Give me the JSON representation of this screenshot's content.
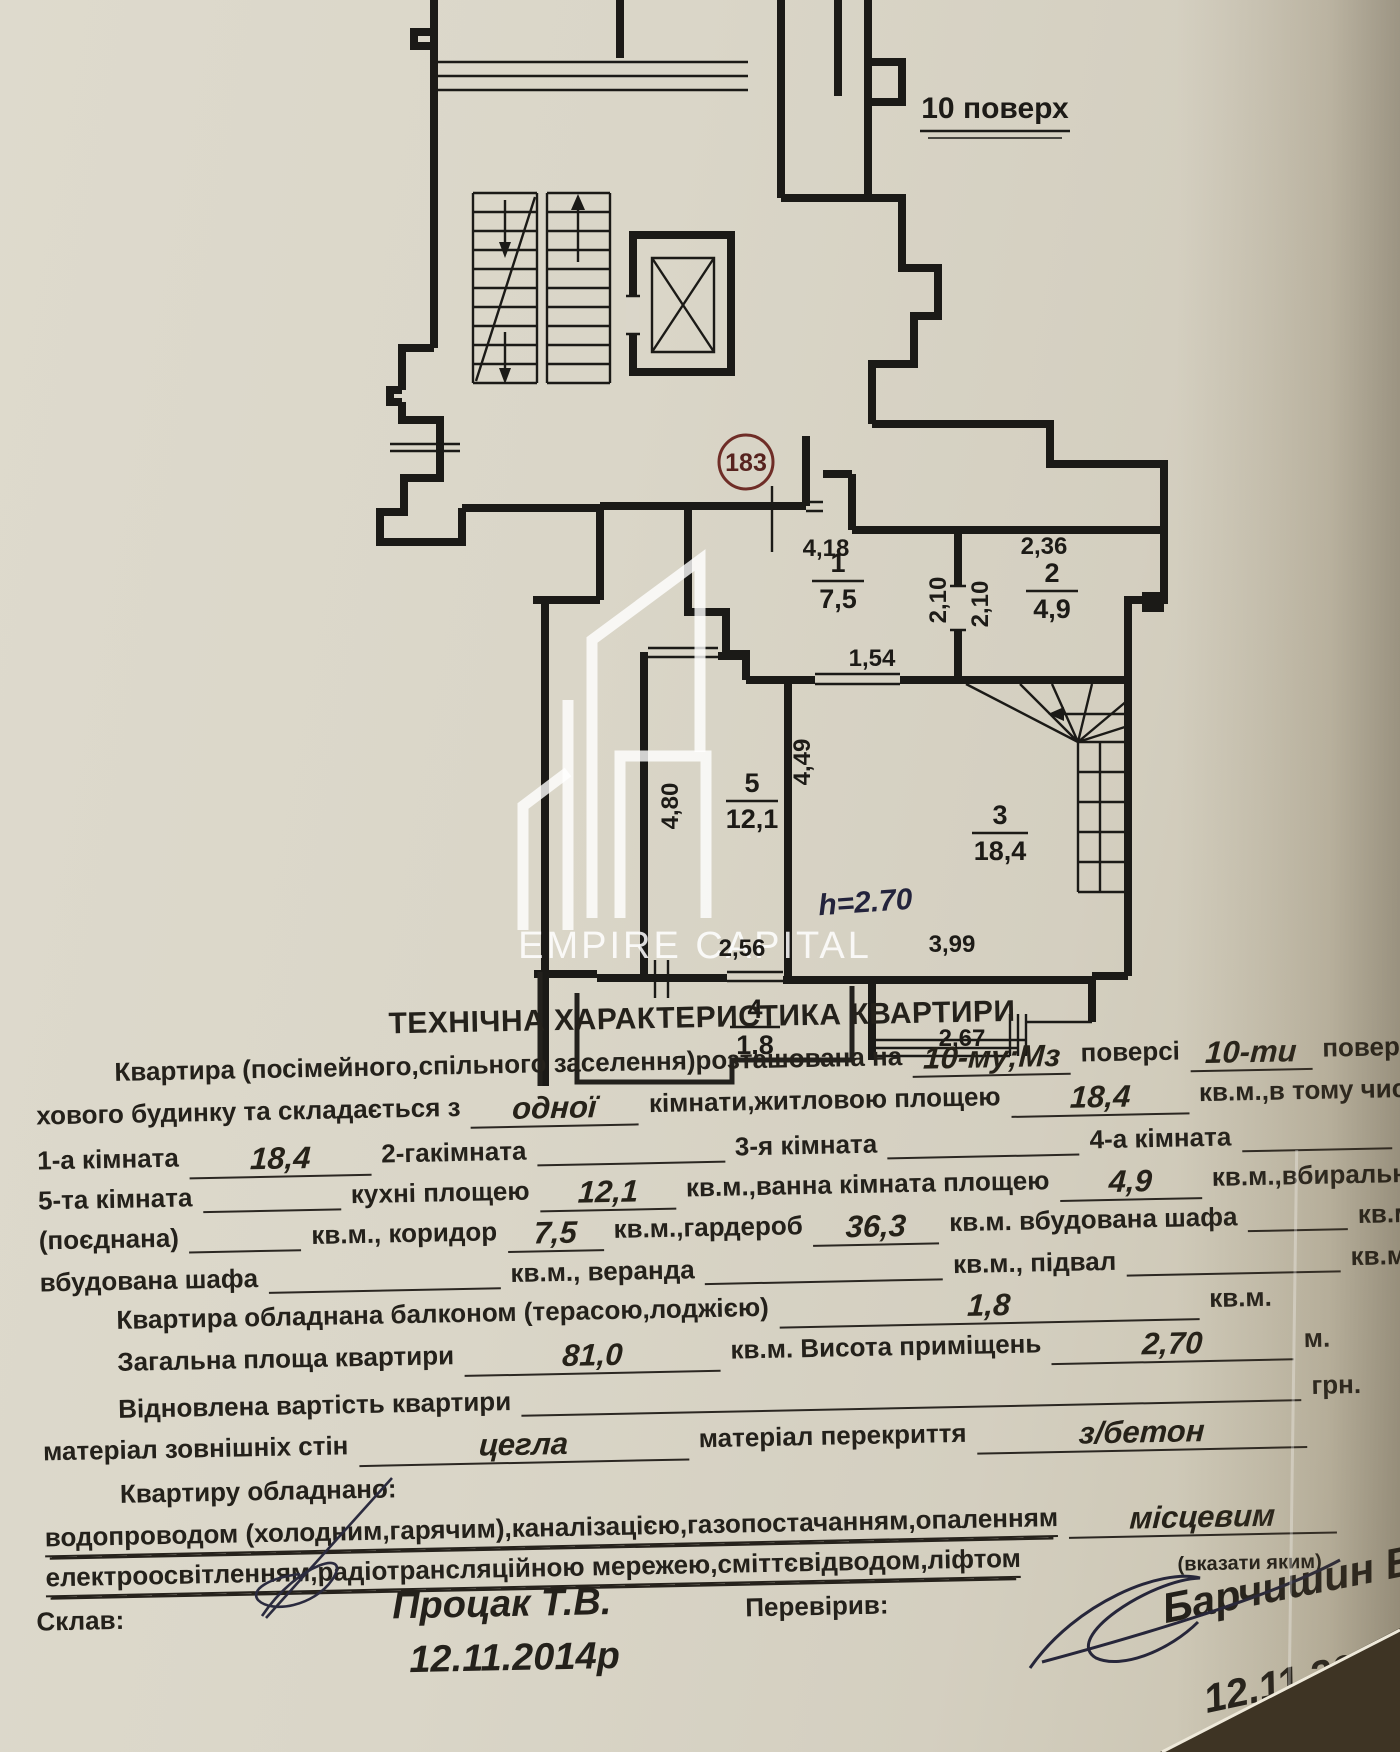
{
  "plan": {
    "floor": "10 поверх",
    "apt": "183",
    "h_note": "h=2.70",
    "wm_text": "EMPIRE CAPITAL",
    "rooms": {
      "r1": {
        "num": "1",
        "area": "7,5"
      },
      "r2": {
        "num": "2",
        "area": "4,9"
      },
      "r3": {
        "num": "3",
        "area": "18,4"
      },
      "r4": {
        "num": "4",
        "area": "1,8"
      },
      "r5": {
        "num": "5",
        "area": "12,1"
      }
    },
    "dims": {
      "d418": "4,18",
      "d236": "2,36",
      "d210a": "2,10",
      "d210b": "2,10",
      "d154": "1,54",
      "d480": "4,80",
      "d449": "4,49",
      "d399": "3,99",
      "d256": "2,56",
      "d267": "2,67"
    }
  },
  "form": {
    "title": "ТЕХНІЧНА ХАРАКТЕРИСТИКА КВАРТИРИ",
    "l1": {
      "a": "Квартира (посімейного,спільного заселення)розташована на",
      "v1": "10-му;Мз",
      "b": "поверсі",
      "v2": "10-ти",
      "c": "повер-"
    },
    "l2": {
      "a": "хового будинку та складається з",
      "v1": "одної",
      "b": "кімнати,житловою площею",
      "v2": "18,4",
      "c": "кв.м.,в тому числі:"
    },
    "l3": {
      "a": "1-а кімната",
      "v1": "18,4",
      "b": "2-гакімната",
      "c": "3-я кімната",
      "d": "4-а кімната"
    },
    "l4": {
      "a": "5-та кімната",
      "b": "кухні площею",
      "v1": "12,1",
      "c": "кв.м.,ванна кімната площею",
      "v2": "4,9",
      "d": "кв.м.,вбиральня"
    },
    "l5": {
      "a": "(поєднана)",
      "b": "кв.м., коридор",
      "v1": "7,5",
      "c": "кв.м.,гардероб",
      "v2": "36,3",
      "d": "кв.м. вбудована шафа",
      "e": "кв.м."
    },
    "l6": {
      "a": "вбудована шафа",
      "b": "кв.м., веранда",
      "c": "кв.м., підвал",
      "d": "кв.м."
    },
    "l7": {
      "a": "Квартира обладнана балконом (терасою,лоджією)",
      "v1": "1,8",
      "b": "кв.м."
    },
    "l8": {
      "a": "Загальна площа квартири",
      "v1": "81,0",
      "b": "кв.м. Висота приміщень",
      "v2": "2,70",
      "c": "м."
    },
    "l9": {
      "a": "Відновлена вартість квартири",
      "b": "грн."
    },
    "l10": {
      "a": "матеріал зовнішніх стін",
      "v1": "цегла",
      "b": "матеріал перекриття",
      "v2": "з/бетон"
    },
    "l11": {
      "a": "Квартиру обладнано:"
    },
    "l12": {
      "a": "водопроводом (холодним,гарячим),каналізацією,газопостачанням,опаленням",
      "v1": "місцевим"
    },
    "l13": {
      "a": "електроосвітленням,радіотрансляційною мережею,сміттєвідводом,ліфтом",
      "b": "(вказати яким)"
    }
  },
  "footer": {
    "made_label": "Склав:",
    "made_name": "Процак Т.В.",
    "made_date": "12.11.2014р",
    "checked_label": "Перевірив:",
    "checked_name": "Барчишин В.І.",
    "checked_date": "12.11.2014р"
  }
}
